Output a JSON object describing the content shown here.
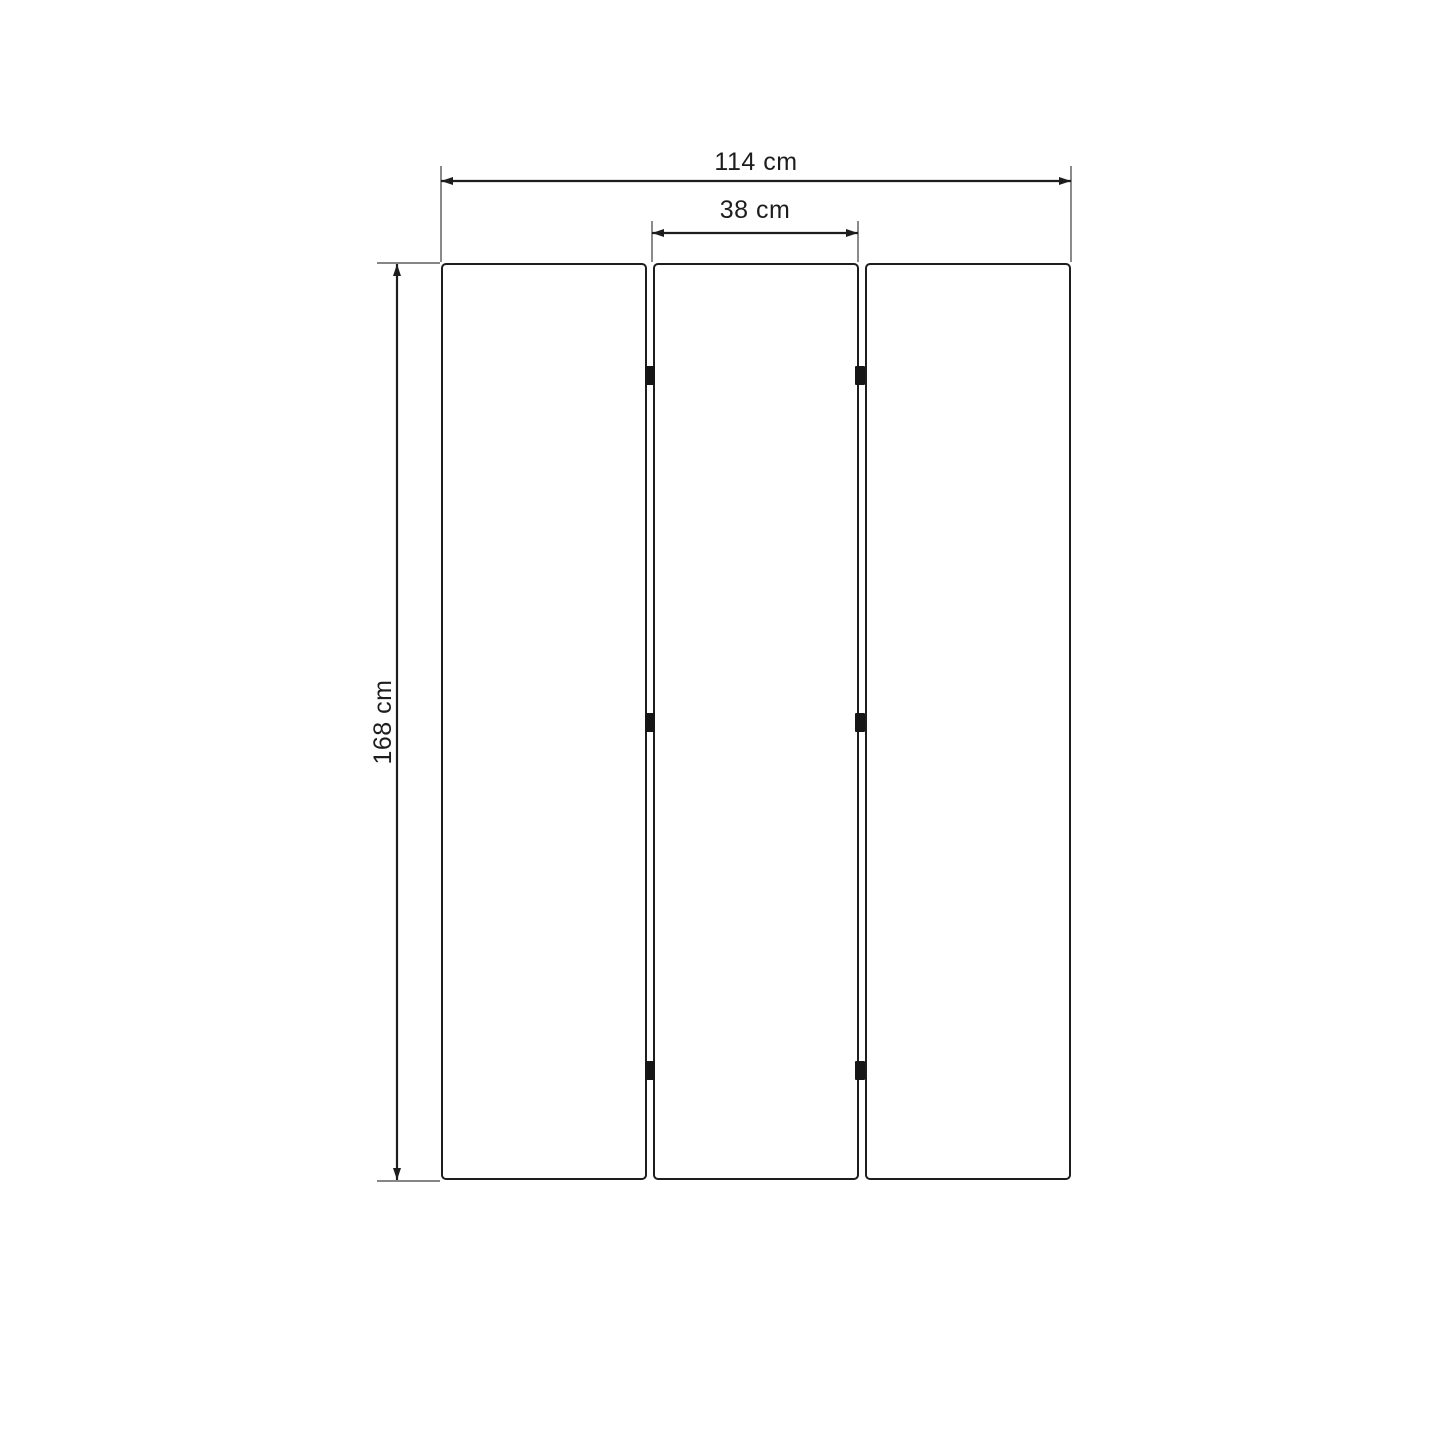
{
  "diagram": {
    "panel_count": 3,
    "hinges_per_gap": 3,
    "dimensions": {
      "total_width": {
        "label": "114 cm",
        "value": 114,
        "unit": "cm"
      },
      "panel_width": {
        "label": "38 cm",
        "value": 38,
        "unit": "cm"
      },
      "height": {
        "label": "168 cm",
        "value": 168,
        "unit": "cm"
      }
    },
    "colors": {
      "background": "#ffffff",
      "outline": "#1d1d1d",
      "extension_line": "#3d3d3d",
      "hinge": "#161616",
      "text": "#1d1d1d"
    }
  }
}
